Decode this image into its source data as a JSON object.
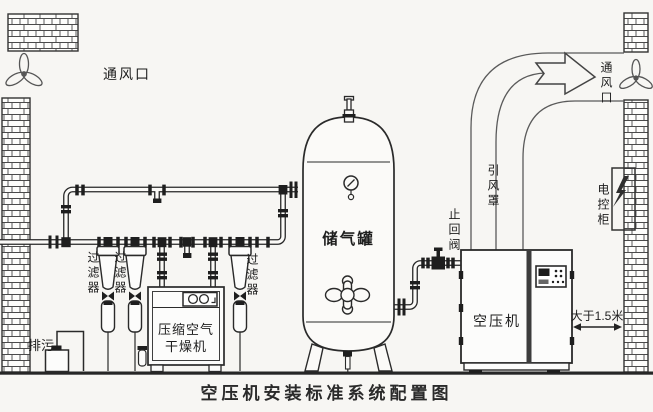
{
  "diagram_title": "空压机安装标准系统配置图",
  "labels": {
    "vent_left": "通风口",
    "vent_right": "通风口",
    "filter_left": "过滤器",
    "filter_mid": "过滤器",
    "filter_right": "过滤器",
    "blowdown": "排污",
    "dryer_line1": "压缩空气",
    "dryer_line2": "干燥机",
    "air_tank": "储气罐",
    "check_valve": "止回阀",
    "draft_hood": "引风罩",
    "air_compressor": "空压机",
    "control_cabinet": "电控柜",
    "wall_distance": "大于1.5米"
  },
  "icons": {
    "fan_left": "fan-icon",
    "fan_right": "fan-icon",
    "lightning": "lightning-icon",
    "pressure_gauge": "gauge-icon",
    "safety_valve": "safety-valve-icon",
    "manhole": "manhole-icon",
    "airflow_arrow": "arrow-right-icon"
  },
  "colors": {
    "background": "#f7f6f3",
    "line": "#2a2a2a",
    "text": "#1e1e1e"
  }
}
